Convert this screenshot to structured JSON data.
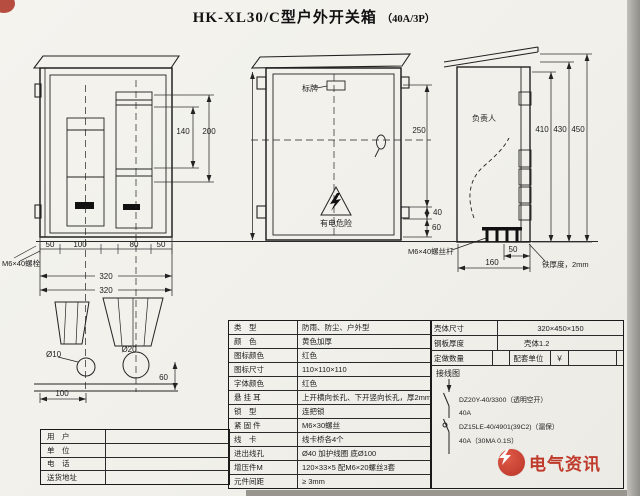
{
  "header": {
    "title": "HK-XL30/C型户外开关箱",
    "spec": "（40A/3P）"
  },
  "front_open_view": {
    "dim_140": "140",
    "dim_200": "200",
    "bottom_dims": [
      "50",
      "100",
      "80",
      "50"
    ],
    "dim_320_a": "320",
    "dim_320_b": "320",
    "bolt_note": "M6×40螺栓"
  },
  "base_view": {
    "hole_small": "Ø10",
    "hole_big": "Ø20",
    "dim_100": "100",
    "dim_60": "60"
  },
  "front_closed_view": {
    "nameplate_label": "标牌",
    "warning_text": "有电危险",
    "dim_250": "250",
    "dim_40": "40",
    "dim_60": "60"
  },
  "side_view": {
    "person_label": "负责人",
    "dim_410": "410",
    "dim_430": "430",
    "dim_450": "450",
    "dim_50": "50",
    "dim_160": "160",
    "bolt_note": "M6×40螺丝杆",
    "thickness_note": "铁厚度，2mm"
  },
  "spec_table": {
    "rows": [
      {
        "label": "类　型",
        "value": "防雨、防尘、户外型"
      },
      {
        "label": "颜　色",
        "value": "黄色加厚"
      },
      {
        "label": "图标颜色",
        "value": "红色"
      },
      {
        "label": "图标尺寸",
        "value": "110×110×110"
      },
      {
        "label": "字体颜色",
        "value": "红色"
      },
      {
        "label": "悬 挂 耳",
        "value": "上开横向长孔、下开竖向长孔，厚2mm"
      },
      {
        "label": "锁　型",
        "value": "连把锁"
      },
      {
        "label": "紧 固 件",
        "value": "M6×30螺丝"
      },
      {
        "label": "线　卡",
        "value": "线卡桥各4个"
      },
      {
        "label": "进出线孔",
        "value": "Ø40 加护线圈 底Ø100"
      },
      {
        "label": "增压件M",
        "value": "120×33×5 配M6×20螺丝3套"
      },
      {
        "label": "元件间距",
        "value": "≥ 3mm"
      }
    ]
  },
  "order_table": {
    "shell_size_label": "壳体尺寸",
    "shell_size": "320×450×150",
    "plate_label": "钢板厚度",
    "plate_value": "壳体1.2",
    "qty_label": "定做数量",
    "qty_value": "",
    "unit_label": "配套单位",
    "unit_value": "￥",
    "wiring_label": "接线图"
  },
  "wiring": {
    "breaker1": "DZ20Y-40/3300（透明空开）",
    "breaker1_current": "40A",
    "breaker2": "DZ15LE-40/4901(39C2)（漏保）",
    "breaker2_current": "40A（30MA 0.1S）"
  },
  "customer_table": {
    "rows": [
      {
        "label": "用　户",
        "value": ""
      },
      {
        "label": "单　位",
        "value": ""
      },
      {
        "label": "电　话",
        "value": ""
      },
      {
        "label": "送货地址",
        "value": ""
      }
    ]
  },
  "watermark": {
    "text": "电气资讯",
    "icon": "lightning-in-circle"
  },
  "colors": {
    "line": "#222222",
    "watermark_red": "#bf3a2b",
    "paper": "#f2f1ec"
  }
}
